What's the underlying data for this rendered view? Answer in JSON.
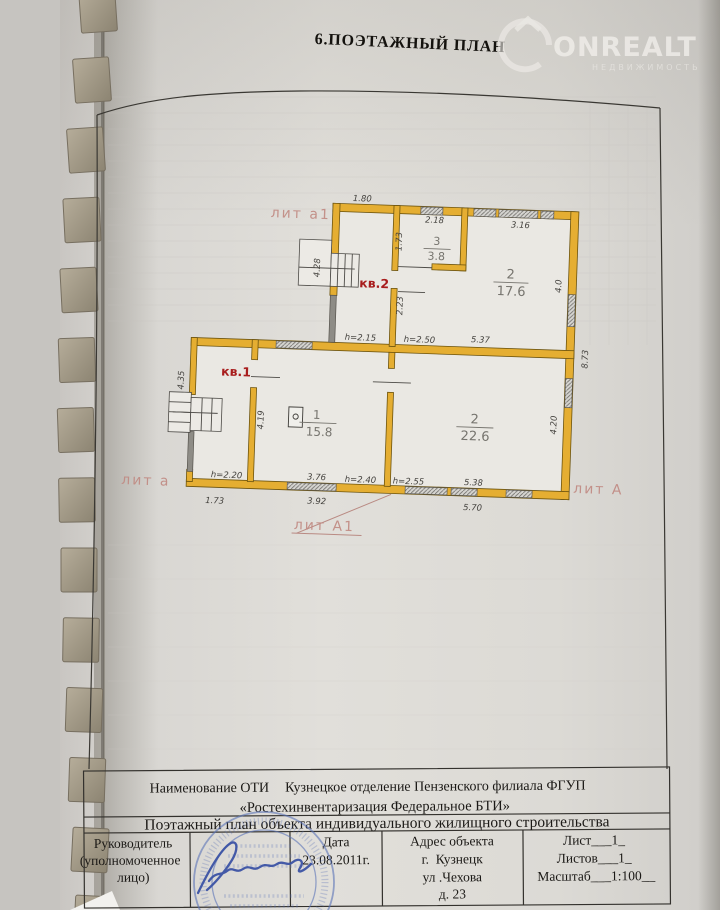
{
  "header": {
    "title": "6.ПОЭТАЖНЫЙ ПЛАН",
    "watermark": {
      "brand": "ONREALT",
      "tagline": "НЕДВИЖИМОСТЬ"
    }
  },
  "plan": {
    "flats": {
      "kv1": "кв.1",
      "kv2": "кв.2"
    },
    "liters": {
      "a1_top": "лит а1",
      "a_left": "лит а",
      "A_right": "лит А",
      "A1_bottom": "лит А1"
    },
    "rooms": [
      {
        "num": "3",
        "area": "3.8"
      },
      {
        "num": "2",
        "area": "17.6"
      },
      {
        "num": "1",
        "area": "15.8"
      },
      {
        "num": "2",
        "area": "22.6"
      }
    ],
    "dims": {
      "top_a1": "1.80",
      "room3_top": "2.18",
      "room2u_top": "3.16",
      "hall_upper": "1.73",
      "stairs_upper": "4.28",
      "hall_lower": "2.23",
      "right_upper": "4.0",
      "h_left": "h=2.15",
      "h_mid": "h=2.50",
      "mid_right": "5.37",
      "right_outer": "8.73",
      "annex_left": "4.35",
      "room1_left": "4.19",
      "room2_right": "4.20",
      "h_annex": "h=2.20",
      "room1_bottom": "3.76",
      "h_room1": "h=2.40",
      "h_room2": "h=2.55",
      "room2_bottom": "5.38",
      "annex_bottom": "1.73",
      "bottom_mid": "3.92",
      "bottom_right": "5.70"
    }
  },
  "footer_table": {
    "org_label": "Наименование ОТИ",
    "org_name": "Кузнецкое отделение Пензенского филиала ФГУП",
    "org_name2": "«Ростехинвентаризация Федеральное БТИ»",
    "doc_type": "Поэтажный план объекта индивидуального жилищного строительства",
    "official": {
      "line1": "Руководитель",
      "line2": "(уполномоченное",
      "line3": "лицо)"
    },
    "date": {
      "label": "Дата",
      "value": "23.08.2011г."
    },
    "address": {
      "label": "Адрес объекта",
      "line1": "г.  Кузнецк",
      "line2": "ул .Чехова",
      "line3": "д. 23"
    },
    "sheet": {
      "list": "Лист___1_",
      "listov": "Листов___1_",
      "scale": "Масштаб___1:100__"
    }
  },
  "colors": {
    "wall_fill": "#e5ae32",
    "cold_wall": "#8e8c86",
    "flat_label": "#a81d1d",
    "liter_label": "#c18a83",
    "stamp_blue": "#5b74b8",
    "signature_blue": "#3b53a5",
    "paper": "#dedcd7"
  }
}
